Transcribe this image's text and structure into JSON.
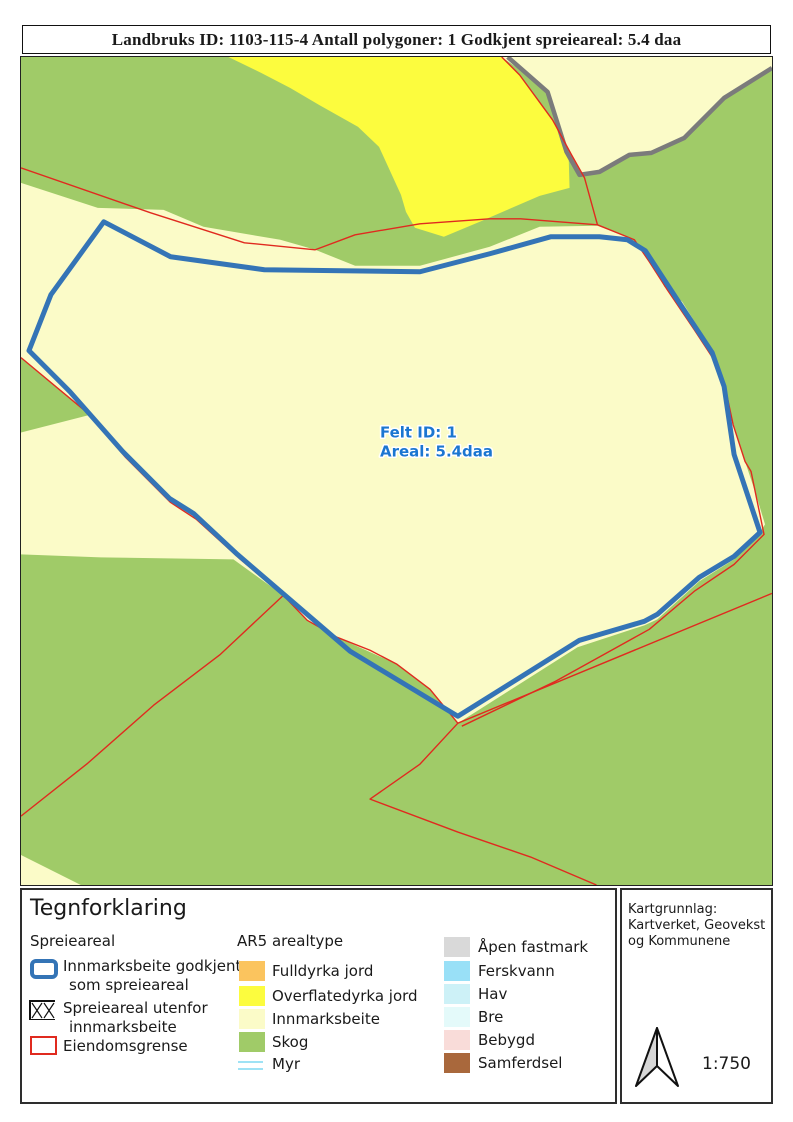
{
  "title": "Landbruks ID: 1103-115-4 Antall polygoner: 1 Godkjent spreieareal: 5.4 daa",
  "map": {
    "field_label_line1": "Felt ID: 1",
    "field_label_line2": "Areal: 5.4daa"
  },
  "legend": {
    "heading": "Tegnforklaring",
    "spreieareal_group": {
      "heading": "Spreieareal",
      "innmarksbeite_godkjent_line1": "Innmarksbeite godkjent",
      "innmarksbeite_godkjent_line2": "som spreieareal",
      "spreieareal_utenfor_line1": "Spreieareal utenfor",
      "spreieareal_utenfor_line2": "innmarksbeite",
      "eiendomsgrense": "Eiendomsgrense"
    },
    "ar5_group": {
      "heading": "AR5 arealtype",
      "items": [
        "Fulldyrka jord",
        "Overflatedyrka jord",
        "Innmarksbeite",
        "Skog",
        "Myr",
        "Åpen fastmark",
        "Ferskvann",
        "Hav",
        "Bre",
        "Bebygd",
        "Samferdsel"
      ]
    }
  },
  "credits": {
    "line1": "Kartgrunnlag:",
    "line2": "Kartverket, Geovekst",
    "line3": "og Kommunene",
    "scale": "1:750"
  },
  "colors": {
    "skog": "#A0CB68",
    "innmarksbeite": "#FBFBC8",
    "overflatedyrka": "#FCFC3E",
    "fulldyrka": "#FBC45E",
    "apen_fastmark": "#D9D9D9",
    "ferskvann": "#99E0F7",
    "hav": "#CDF1F7",
    "bre": "#E4FAFA",
    "bebygd": "#F9DCD9",
    "samferdsel": "#A9683C",
    "myr_line": "#7ED9F2",
    "spreieareal_blue": "#3474B6",
    "eiendomsgrense_red": "#E02A1F",
    "grense_gray": "#7B7B7B",
    "label_blue": "#1B76D1"
  }
}
